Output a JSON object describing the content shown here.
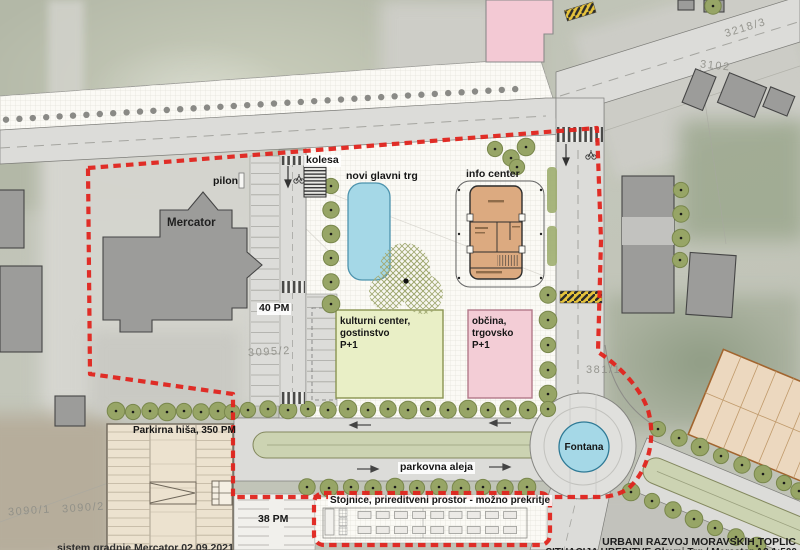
{
  "labels": {
    "mercator": "Mercator",
    "pilon": "pilon",
    "kolesa": "kolesa",
    "novi_glavni_trg": "novi glavni trg",
    "info_center": "info center",
    "kulturni_line1": "kulturni center, gostinstvo",
    "kulturni_line2": "P+1",
    "obcina_line1": "občina, trgovsko",
    "obcina_line2": "P+1",
    "parking_40": "40 PM",
    "parking_38": "38 PM",
    "parkirna_hisa": "Parkirna hiša, 350 PM",
    "parkovna_aleja": "parkovna aleja",
    "fontana": "Fontana",
    "stojnice": "Stojnice, prireditveni prostor - možno prekritje"
  },
  "parcels": {
    "p3218_3": "3218/3",
    "p3102": "3102",
    "p3095_2": "3095/2",
    "p3090_1": "3090/1",
    "p3090_2": "3090/2",
    "p381_1": "381/1"
  },
  "footer": {
    "note": "sistem gradnje Mercator   02.09.2021",
    "title1": "URBANI RAZVOJ MORAVSKIH TOPLIC",
    "title2": "SITUACIJA UREDITVE Glavni Trg / Mercator   A3   1:500"
  },
  "colors": {
    "boundary": "#e0241e",
    "water": "#a5d8e7",
    "info": "#dcaa80",
    "culture": "#e9efc6",
    "muni": "#f3cdd6",
    "garage": "#ece2cf",
    "tree": "#97a566",
    "median": "#ccd3b2"
  }
}
